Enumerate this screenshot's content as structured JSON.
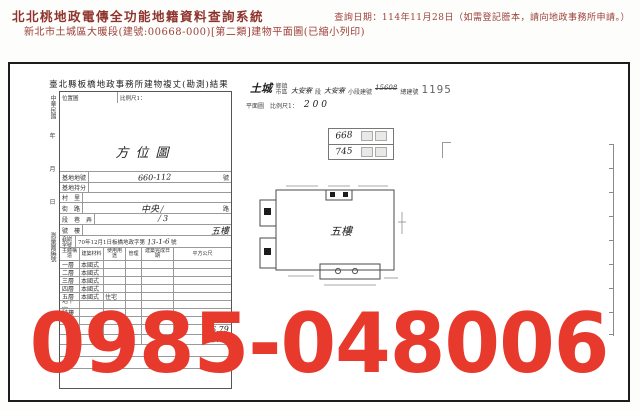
{
  "header": {
    "system_title": "北北桃地政電傳全功能地籍資料查詢系統",
    "query_info": "查詢日期：114年11月28日（如需登記謄本，請向地政事務所申請。）",
    "document_line": "新北市土城區大暖段(建號:00668-000)[第二類]建物平面圖(已縮小列印)",
    "accent_color": "#9e4038"
  },
  "form": {
    "title": "臺北縣板橋地政事務所建物複丈(勘測)結果",
    "top_left_cell": "位置圖",
    "top_right_cell": "比例尺1：",
    "direction_label": "方位圖",
    "vertical_top": "中華民國",
    "vertical_year": "年",
    "vertical_month": "月",
    "vertical_day": "日",
    "vertical_bottom": "測量圖編號",
    "lot_label": "基地地號",
    "lot_value": "660-112",
    "lot_suffix": "號",
    "share_label": "基地持分",
    "village_label": "村　里",
    "street_label": "街　路",
    "street_value": "中央",
    "street_tail": "路",
    "sec_label": "段　巷　弄",
    "sec_value": "3",
    "no_label": "號　樓",
    "no_value": "五樓",
    "license_label": "使用執照字號",
    "license_value": "70年12月1日板橋地政字第",
    "license_hand": "13-1-6",
    "license_suffix": "號",
    "col_headers": [
      "主體構造",
      "建築材料",
      "使用用途",
      "管理",
      "建築完成日期",
      "平方公尺"
    ],
    "floors": [
      {
        "name": "一層",
        "material": "本國式",
        "use": "",
        "area": ""
      },
      {
        "name": "二層",
        "material": "本國式",
        "use": "",
        "area": ""
      },
      {
        "name": "三層",
        "material": "本國式",
        "use": "",
        "area": ""
      },
      {
        "name": "四層",
        "material": "本國式",
        "use": "",
        "area": ""
      },
      {
        "name": "五層",
        "material": "本國式",
        "use": "住宅",
        "area": "96.79"
      },
      {
        "name": "地下室",
        "material": "",
        "use": "",
        "area": ""
      },
      {
        "name": "騎樓",
        "material": "",
        "use": "",
        "area": ""
      },
      {
        "name": "平台",
        "material": "",
        "use": "",
        "area": ""
      }
    ],
    "total_1": "96.79",
    "total_2": "96.79"
  },
  "plan": {
    "town": "土城",
    "town_label_1": "鄉鎮",
    "town_label_2": "市區",
    "section_value": "大安寮",
    "section_label": "段",
    "subsection_value": "大安寮",
    "subsection_label": "小段建號",
    "crossed_number": "15608",
    "total_label": "總建號",
    "total_number": "1195",
    "line2_prefix": "平面圖",
    "scale_label": "比例尺1：",
    "scale_value": "200",
    "stamp_numbers": [
      "668",
      "745"
    ],
    "floor_label": "五樓"
  },
  "watermark": {
    "text": "0985-048006",
    "color": "#e8392d"
  }
}
